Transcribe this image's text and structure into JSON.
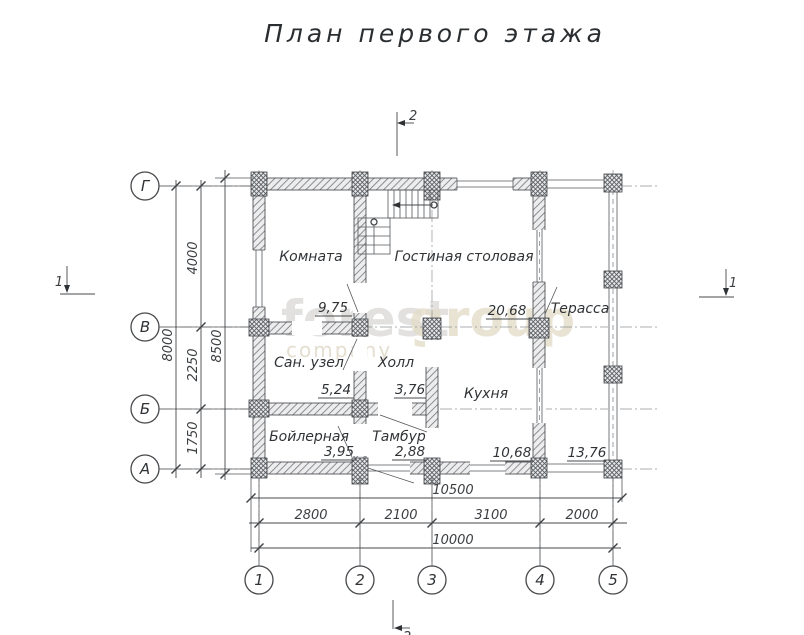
{
  "title": "План первого этажа",
  "axes": {
    "rows": [
      "Г",
      "В",
      "Б",
      "А"
    ],
    "cols": [
      "1",
      "2",
      "3",
      "4",
      "5"
    ]
  },
  "rooms": [
    {
      "name": "Комната",
      "area": "9,75"
    },
    {
      "name": "Гостиная столовая",
      "area": "20,68"
    },
    {
      "name": "Терасса",
      "area": "13,76"
    },
    {
      "name": "Сан.  узел",
      "area": "5,24"
    },
    {
      "name": "Холл",
      "area": "3,76"
    },
    {
      "name": "Кухня",
      "area": "10,68"
    },
    {
      "name": "Бойлерная",
      "area": "3,95"
    },
    {
      "name": "Тамбур",
      "area": "2,88"
    }
  ],
  "dimensions": {
    "left": {
      "outer": "8500",
      "overall": "8000",
      "segments": [
        "4000",
        "2250",
        "1750"
      ]
    },
    "bottom": {
      "outer": "10500",
      "overall": "10000",
      "segments": [
        "2800",
        "2100",
        "3100",
        "2000"
      ]
    }
  },
  "sections": {
    "top": "2",
    "bottom": "2",
    "left": "1",
    "right": "1"
  },
  "watermark": {
    "word1": "forest",
    "word2": "group",
    "word3": "company"
  },
  "colors": {
    "line": "#45484b",
    "wall_hatch": "#7a7e82",
    "text": "#303336",
    "watermark_gray": "#d9d8d5",
    "watermark_beige": "#e4ddc9"
  }
}
